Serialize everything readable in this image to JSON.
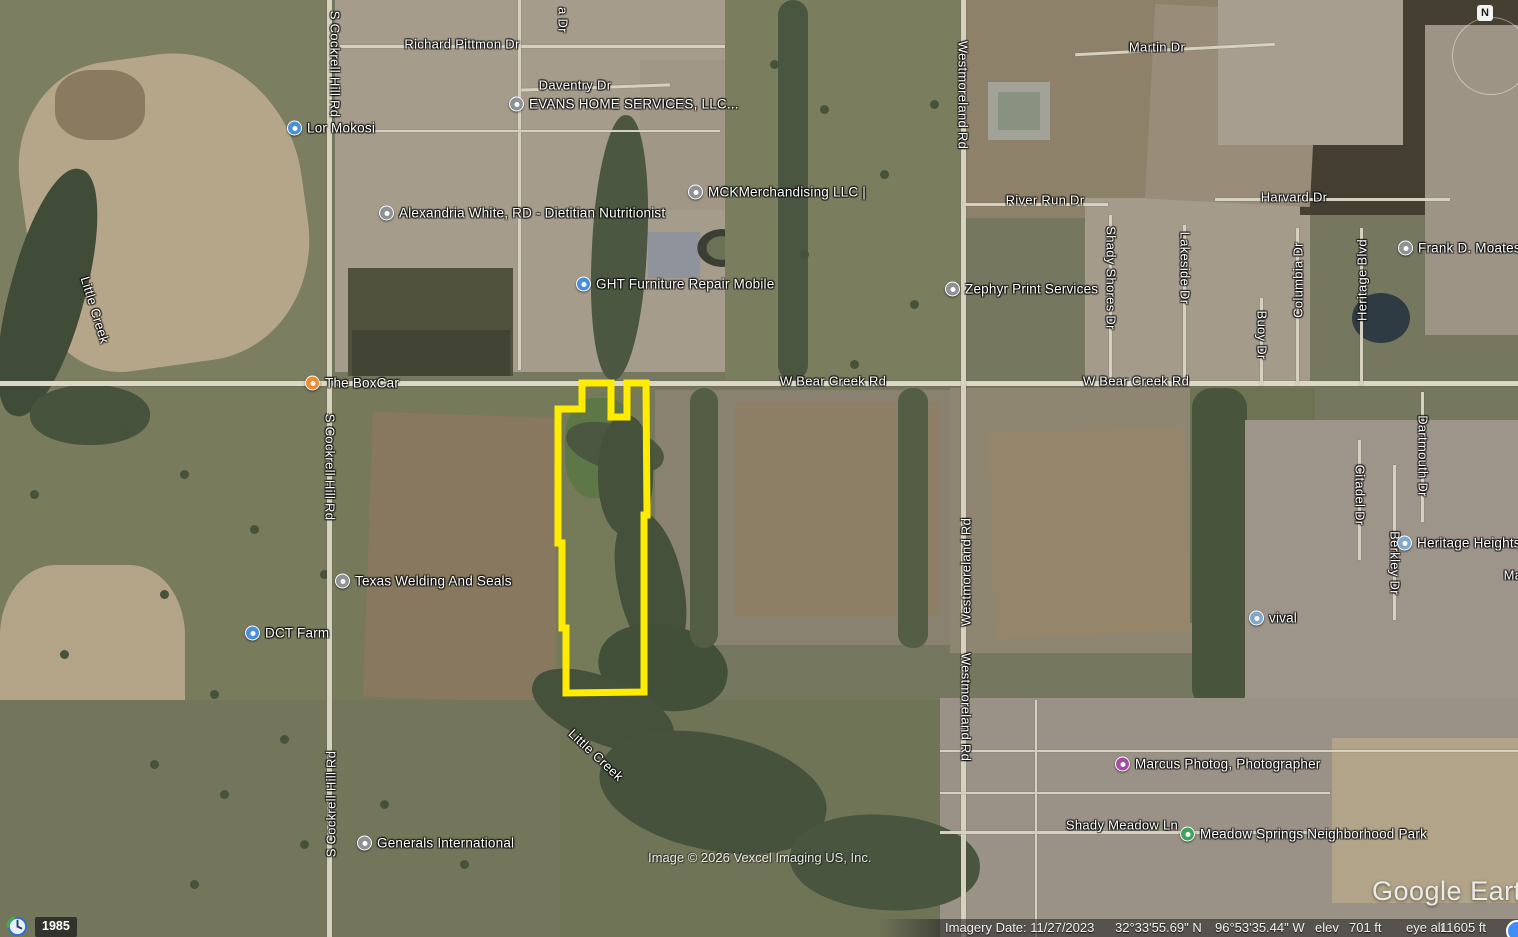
{
  "app": {
    "name": "Google Earth"
  },
  "map": {
    "compass_label": "N",
    "watermark": "Google Earth",
    "copyright": "Image © 2026 Vexcel Imaging US, Inc.",
    "history_year": "1985",
    "status_bar": {
      "imagery_date": "Imagery Date: 11/27/2023",
      "latitude": "32°33'55.69\" N",
      "longitude": "96°53'35.44\" W",
      "elev_label": "elev",
      "elev_value": "701 ft",
      "eye_alt_label": "eye alt",
      "eye_alt_value": "11605 ft"
    },
    "parcel_outline": {
      "color": "#ffec00",
      "points": "582,383 611,383 611,417 627,417 627,383 646,383 647,515 644,515 644,692 566,693 566,628 562,628 562,543 558,543 558,409 582,409"
    },
    "street_labels": [
      {
        "text": "Richard Pittmon Dr",
        "x": 462,
        "y": 44,
        "rot": 0
      },
      {
        "text": "a Dr",
        "x": 563,
        "y": 20,
        "rot": 90
      },
      {
        "text": "Daventry Dr",
        "x": 575,
        "y": 85,
        "rot": 0
      },
      {
        "text": "S Cockrell Hill Rd",
        "x": 335,
        "y": 64,
        "rot": 90
      },
      {
        "text": "S Cockrell Hill Rd",
        "x": 330,
        "y": 467,
        "rot": 90
      },
      {
        "text": "S Cockrell Hill Rd",
        "x": 331,
        "y": 804,
        "rot": -90
      },
      {
        "text": "Westmoreland Rd",
        "x": 963,
        "y": 95,
        "rot": 90
      },
      {
        "text": "Westmoreland Rd",
        "x": 966,
        "y": 572,
        "rot": -90
      },
      {
        "text": "Westmoreland Rd",
        "x": 966,
        "y": 707,
        "rot": 90
      },
      {
        "text": "W Bear Creek Rd",
        "x": 833,
        "y": 381,
        "rot": 0
      },
      {
        "text": "W Bear Creek Rd",
        "x": 1136,
        "y": 381,
        "rot": 0
      },
      {
        "text": "River Run Dr",
        "x": 1045,
        "y": 200,
        "rot": 0
      },
      {
        "text": "Martin Dr",
        "x": 1157,
        "y": 47,
        "rot": 0
      },
      {
        "text": "Harvard Dr",
        "x": 1294,
        "y": 197,
        "rot": 0
      },
      {
        "text": "Shady Shores Dr",
        "x": 1111,
        "y": 278,
        "rot": 90
      },
      {
        "text": "Lakeside Dr",
        "x": 1185,
        "y": 268,
        "rot": 90
      },
      {
        "text": "Buoy Dr",
        "x": 1262,
        "y": 335,
        "rot": 90
      },
      {
        "text": "Columbia Dr",
        "x": 1298,
        "y": 280,
        "rot": -90
      },
      {
        "text": "Heritage Blvd",
        "x": 1362,
        "y": 280,
        "rot": -90
      },
      {
        "text": "Dartmouth Dr",
        "x": 1423,
        "y": 456,
        "rot": 90
      },
      {
        "text": "Citadel Dr",
        "x": 1360,
        "y": 495,
        "rot": 90
      },
      {
        "text": "Berkley Dr",
        "x": 1395,
        "y": 563,
        "rot": 90
      },
      {
        "text": "Shady Meadow Ln",
        "x": 1122,
        "y": 825,
        "rot": 0
      },
      {
        "text": "Little Creek",
        "x": 95,
        "y": 310,
        "rot": 73
      },
      {
        "text": "Little Creek",
        "x": 596,
        "y": 755,
        "rot": 43
      },
      {
        "text": "Ma",
        "x": 1513,
        "y": 575,
        "rot": 0
      }
    ],
    "place_labels": [
      {
        "text": "Lor Mokosi",
        "x": 295,
        "y": 128,
        "icon": "lodging",
        "color": "#4a90d9"
      },
      {
        "text": "EVANS HOME SERVICES, LLC...",
        "x": 517,
        "y": 104,
        "icon": "business-pin",
        "color": "#8d9297"
      },
      {
        "text": "MCKMerchandising LLC |",
        "x": 696,
        "y": 192,
        "icon": "business-pin",
        "color": "#8d9297"
      },
      {
        "text": "Alexandria White, RD - Dietitian Nutritionist",
        "x": 387,
        "y": 213,
        "icon": "business-pin",
        "color": "#8d9297"
      },
      {
        "text": "GHT Furniture Repair Mobile",
        "x": 584,
        "y": 284,
        "icon": "lodging",
        "color": "#4a90d9"
      },
      {
        "text": "Zephyr Print Services",
        "x": 953,
        "y": 289,
        "icon": "business-pin",
        "color": "#8d9297"
      },
      {
        "text": "The BoxCar",
        "x": 313,
        "y": 383,
        "icon": "restaurant",
        "color": "#ef8b2e"
      },
      {
        "text": "Texas Welding And Seals",
        "x": 343,
        "y": 581,
        "icon": "business-pin",
        "color": "#8d9297"
      },
      {
        "text": "DCT Farm",
        "x": 253,
        "y": 633,
        "icon": "lodging",
        "color": "#4a90d9"
      },
      {
        "text": "Frank D. Moates",
        "x": 1406,
        "y": 248,
        "icon": "business-pin",
        "color": "#8d9297"
      },
      {
        "text": "Heritage Heights",
        "x": 1405,
        "y": 543,
        "icon": "generic-place",
        "color": "#7fa8cc"
      },
      {
        "text": "vival",
        "x": 1257,
        "y": 618,
        "icon": "generic-place",
        "color": "#7fa8cc"
      },
      {
        "text": "Marcus Photog, Photographer",
        "x": 1123,
        "y": 764,
        "icon": "camera",
        "color": "#a64ca6"
      },
      {
        "text": "Meadow Springs Neighborhood Park",
        "x": 1188,
        "y": 834,
        "icon": "park",
        "color": "#3ba55c"
      },
      {
        "text": "Generals International",
        "x": 365,
        "y": 843,
        "icon": "business-pin",
        "color": "#8d9297"
      }
    ]
  }
}
